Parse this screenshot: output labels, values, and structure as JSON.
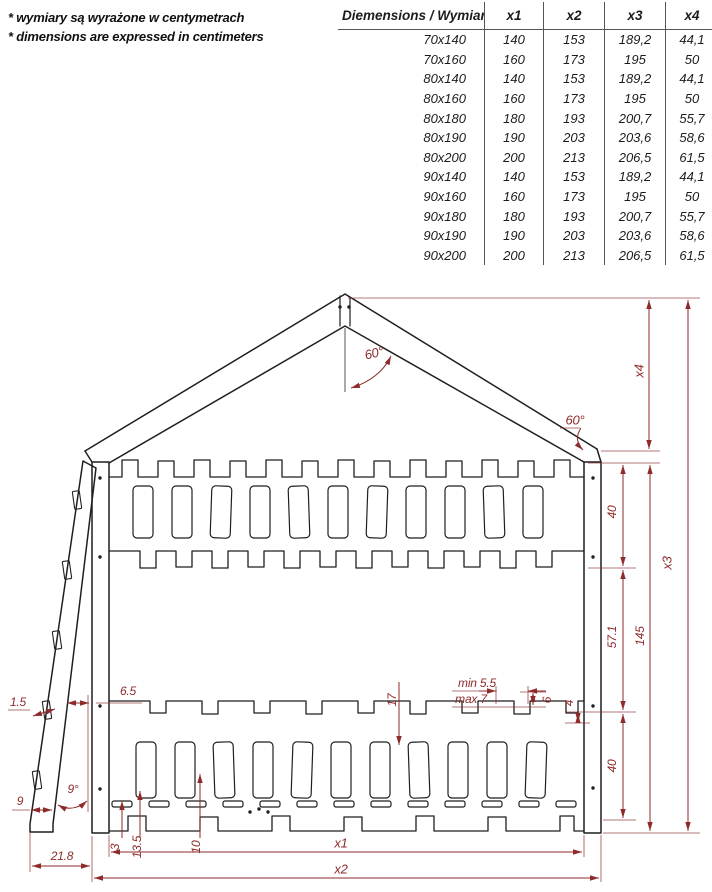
{
  "notes": {
    "line1": "* wymiary są wyrażone w centymetrach",
    "line2": "* dimensions are expressed in centimeters"
  },
  "table": {
    "title": "Diemensions / Wymiary",
    "columns": [
      "x1",
      "x2",
      "x3",
      "x4"
    ],
    "rows": [
      {
        "size": "70x140",
        "x1": "140",
        "x2": "153",
        "x3": "189,2",
        "x4": "44,1"
      },
      {
        "size": "70x160",
        "x1": "160",
        "x2": "173",
        "x3": "195",
        "x4": "50"
      },
      {
        "size": "80x140",
        "x1": "140",
        "x2": "153",
        "x3": "189,2",
        "x4": "44,1"
      },
      {
        "size": "80x160",
        "x1": "160",
        "x2": "173",
        "x3": "195",
        "x4": "50"
      },
      {
        "size": "80x180",
        "x1": "180",
        "x2": "193",
        "x3": "200,7",
        "x4": "55,7"
      },
      {
        "size": "80x190",
        "x1": "190",
        "x2": "203",
        "x3": "203,6",
        "x4": "58,6"
      },
      {
        "size": "80x200",
        "x1": "200",
        "x2": "213",
        "x3": "206,5",
        "x4": "61,5"
      },
      {
        "size": "90x140",
        "x1": "140",
        "x2": "153",
        "x3": "189,2",
        "x4": "44,1"
      },
      {
        "size": "90x160",
        "x1": "160",
        "x2": "173",
        "x3": "195",
        "x4": "50"
      },
      {
        "size": "90x180",
        "x1": "180",
        "x2": "193",
        "x3": "200,7",
        "x4": "55,7"
      },
      {
        "size": "90x190",
        "x1": "190",
        "x2": "203",
        "x3": "203,6",
        "x4": "58,6"
      },
      {
        "size": "90x200",
        "x1": "200",
        "x2": "213",
        "x3": "206,5",
        "x4": "61,5"
      }
    ]
  },
  "drawing": {
    "colors": {
      "structure": "#1f1f1f",
      "dimension": "#8e2a2a"
    },
    "dims": {
      "x1": "x1",
      "x2": "x2",
      "x3": "x3",
      "x4": "x4",
      "height_overall": "145",
      "bunk_gap": "57.1",
      "upper_rail_height": "40",
      "lower_rail_height": "40",
      "roof_angle_peak": "60°",
      "roof_angle_eave": "60°",
      "ladder_angle": "9°",
      "ladder_step_thickness": "1.5",
      "ladder_clearance": "6.5",
      "ladder_foot": "9",
      "ladder_offset": "21.8",
      "batten_thickness": "3",
      "base_height_a": "13.5",
      "base_height_b": "10",
      "slat_length": "17",
      "slot_min": "min 5.5",
      "slot_max": "max 7",
      "notch_step_a": "6",
      "notch_step_b": "4"
    }
  }
}
